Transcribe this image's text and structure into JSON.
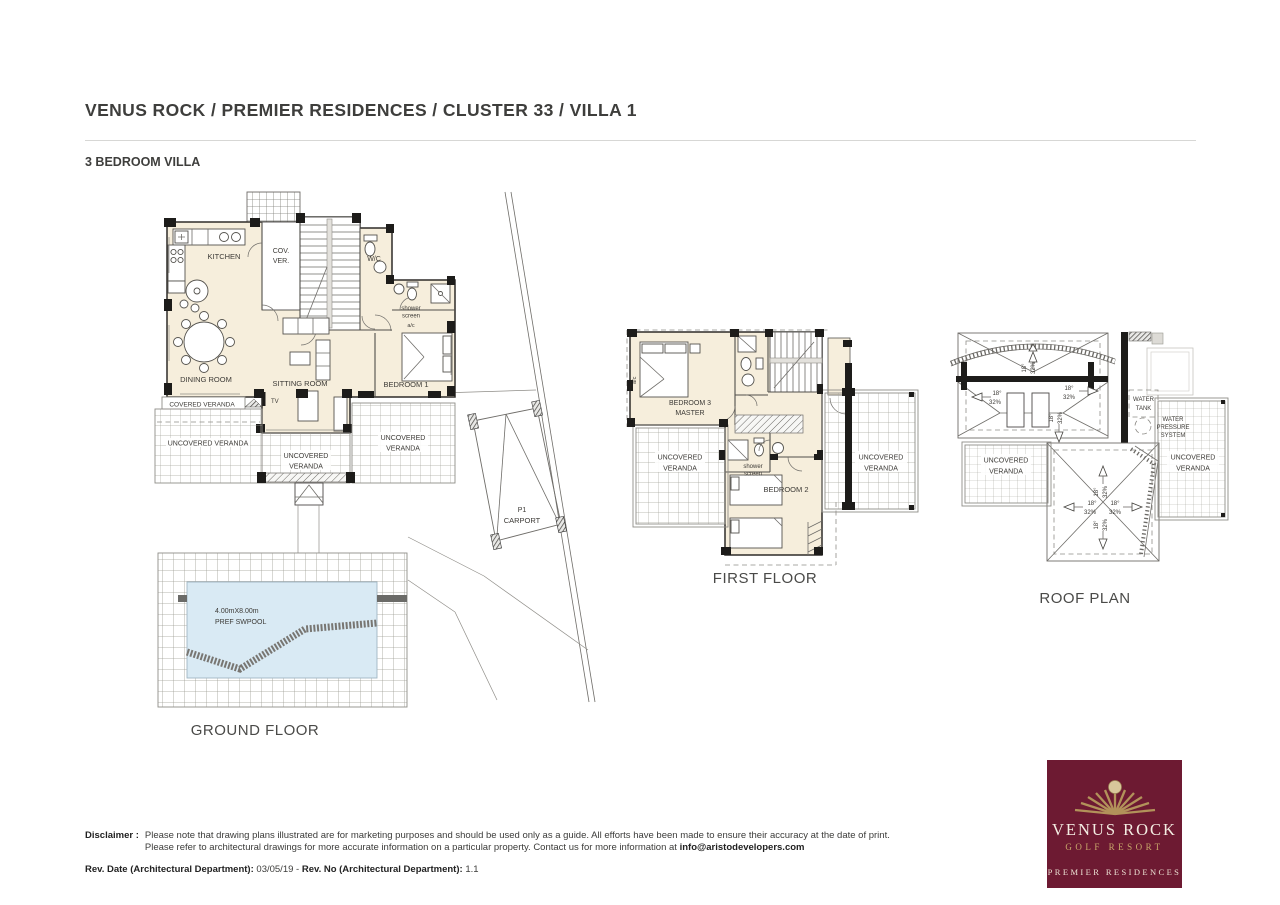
{
  "header": {
    "title": "VENUS ROCK / PREMIER RESIDENCES / CLUSTER 33 / VILLA 1",
    "subtitle": "3 BEDROOM VILLA"
  },
  "plans": {
    "ground": {
      "title": "GROUND FLOOR",
      "rooms": {
        "kitchen": "KITCHEN",
        "cov1": "COV.",
        "cov2": "VER.",
        "wc": "W/C",
        "shower1": "shower",
        "shower2": "screen",
        "ac": "a/c",
        "dining": "DINING ROOM",
        "sitting": "SITTING ROOM",
        "bedroom1": "BEDROOM 1",
        "tv": "TV",
        "covered_veranda": "COVERED VERANDA",
        "uncovered_veranda": "UNCOVERED VERANDA",
        "uncovered": "UNCOVERED",
        "veranda": "VERANDA",
        "pool_size": "4.00mX8.00m",
        "pool_type": "PREF SWPOOL",
        "carport_no": "P1",
        "carport": "CARPORT"
      }
    },
    "first": {
      "title": "FIRST FLOOR",
      "rooms": {
        "bed3a": "BEDROOM 3",
        "bed3b": "MASTER",
        "bed2": "BEDROOM 2",
        "shower1": "shower",
        "shower2": "screen",
        "uncovered": "UNCOVERED",
        "veranda": "VERANDA",
        "ac": "a/c"
      }
    },
    "roof": {
      "title": "ROOF PLAN",
      "labels": {
        "wt1": "WATER",
        "wt2": "TANK",
        "wp1": "WATER",
        "wp2": "PRESSURE",
        "wp3": "SYSTEM",
        "uncovered": "UNCOVERED",
        "veranda": "VERANDA",
        "deg": "18°",
        "pct": "32%"
      }
    }
  },
  "footer": {
    "disclaimer_label": "Disclaimer :",
    "line1": "Please note that drawing plans illustrated are for marketing purposes and should be used only as a guide. All efforts have been made to ensure their accuracy at the date of print.",
    "line2": "Please refer to architectural drawings for more accurate information on a particular property. Contact us for more information at",
    "email": "info@aristodevelopers.com",
    "rev_date_label": "Rev. Date (Architectural Department):",
    "rev_date_value": "03/05/19",
    "rev_sep": "-",
    "rev_no_label": "Rev. No (Architectural Department):",
    "rev_no_value": "1.1"
  },
  "logo": {
    "brand": "VENUS ROCK",
    "sub": "GOLF RESORT",
    "tagline": "PREMIER RESIDENCES"
  }
}
